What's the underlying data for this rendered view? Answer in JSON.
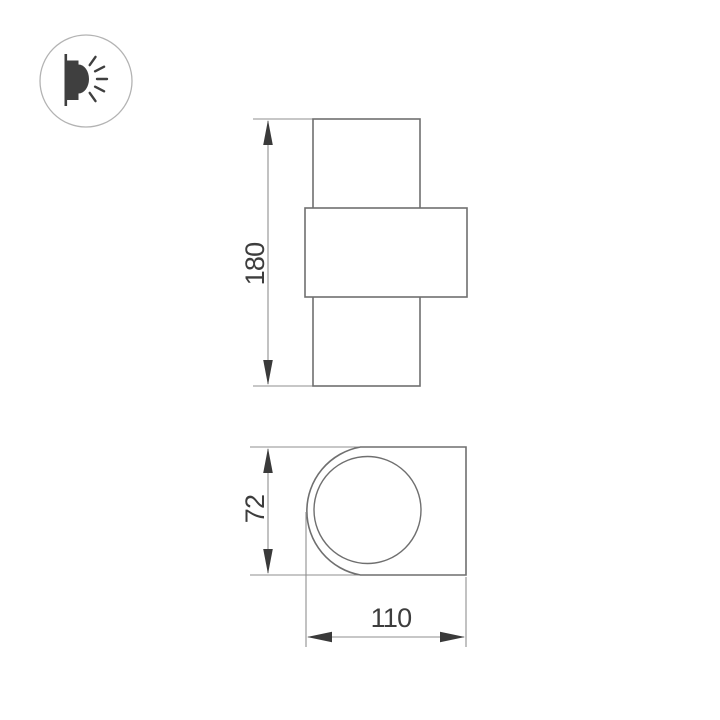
{
  "background_color": "#ffffff",
  "icon_badge": {
    "name": "wall-lamp-light-icon",
    "ring_color": "#b3b3b3",
    "glyph_color": "#3f3f3f"
  },
  "drawing": {
    "shape_stroke": "#6f6f6f",
    "dim_stroke": "#8f8f8f",
    "arrow_color": "#3a3a3a",
    "text_color": "#3d3d3d",
    "front_view": {
      "height_label": "180"
    },
    "side_view": {
      "height_label": "72",
      "width_label": "110"
    }
  }
}
